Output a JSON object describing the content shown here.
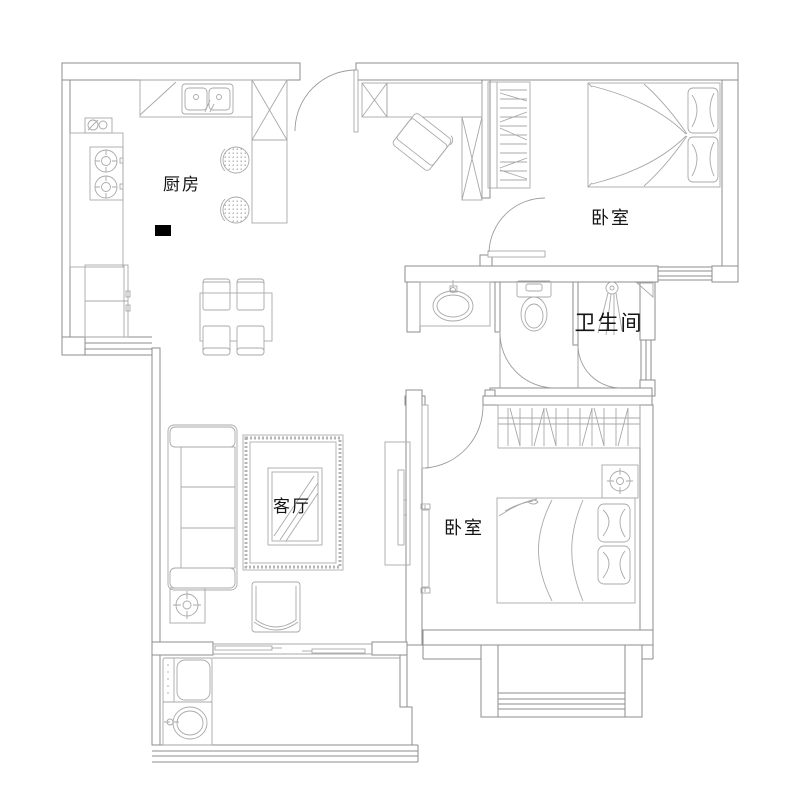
{
  "image_type": "apartment floor plan drawing",
  "colors": {
    "background": "#ffffff",
    "wall_line": "#8e8e8e",
    "furniture_line": "#a9a9a9",
    "label_text": "#141414",
    "marker_fill": "#000000"
  },
  "rooms": {
    "kitchen": {
      "label": "厨房"
    },
    "bedroom_top": {
      "label": "卧室"
    },
    "bathroom": {
      "label": "卫生间"
    },
    "living_room": {
      "label": "客厅"
    },
    "bedroom_bottom": {
      "label": "卧室"
    }
  }
}
